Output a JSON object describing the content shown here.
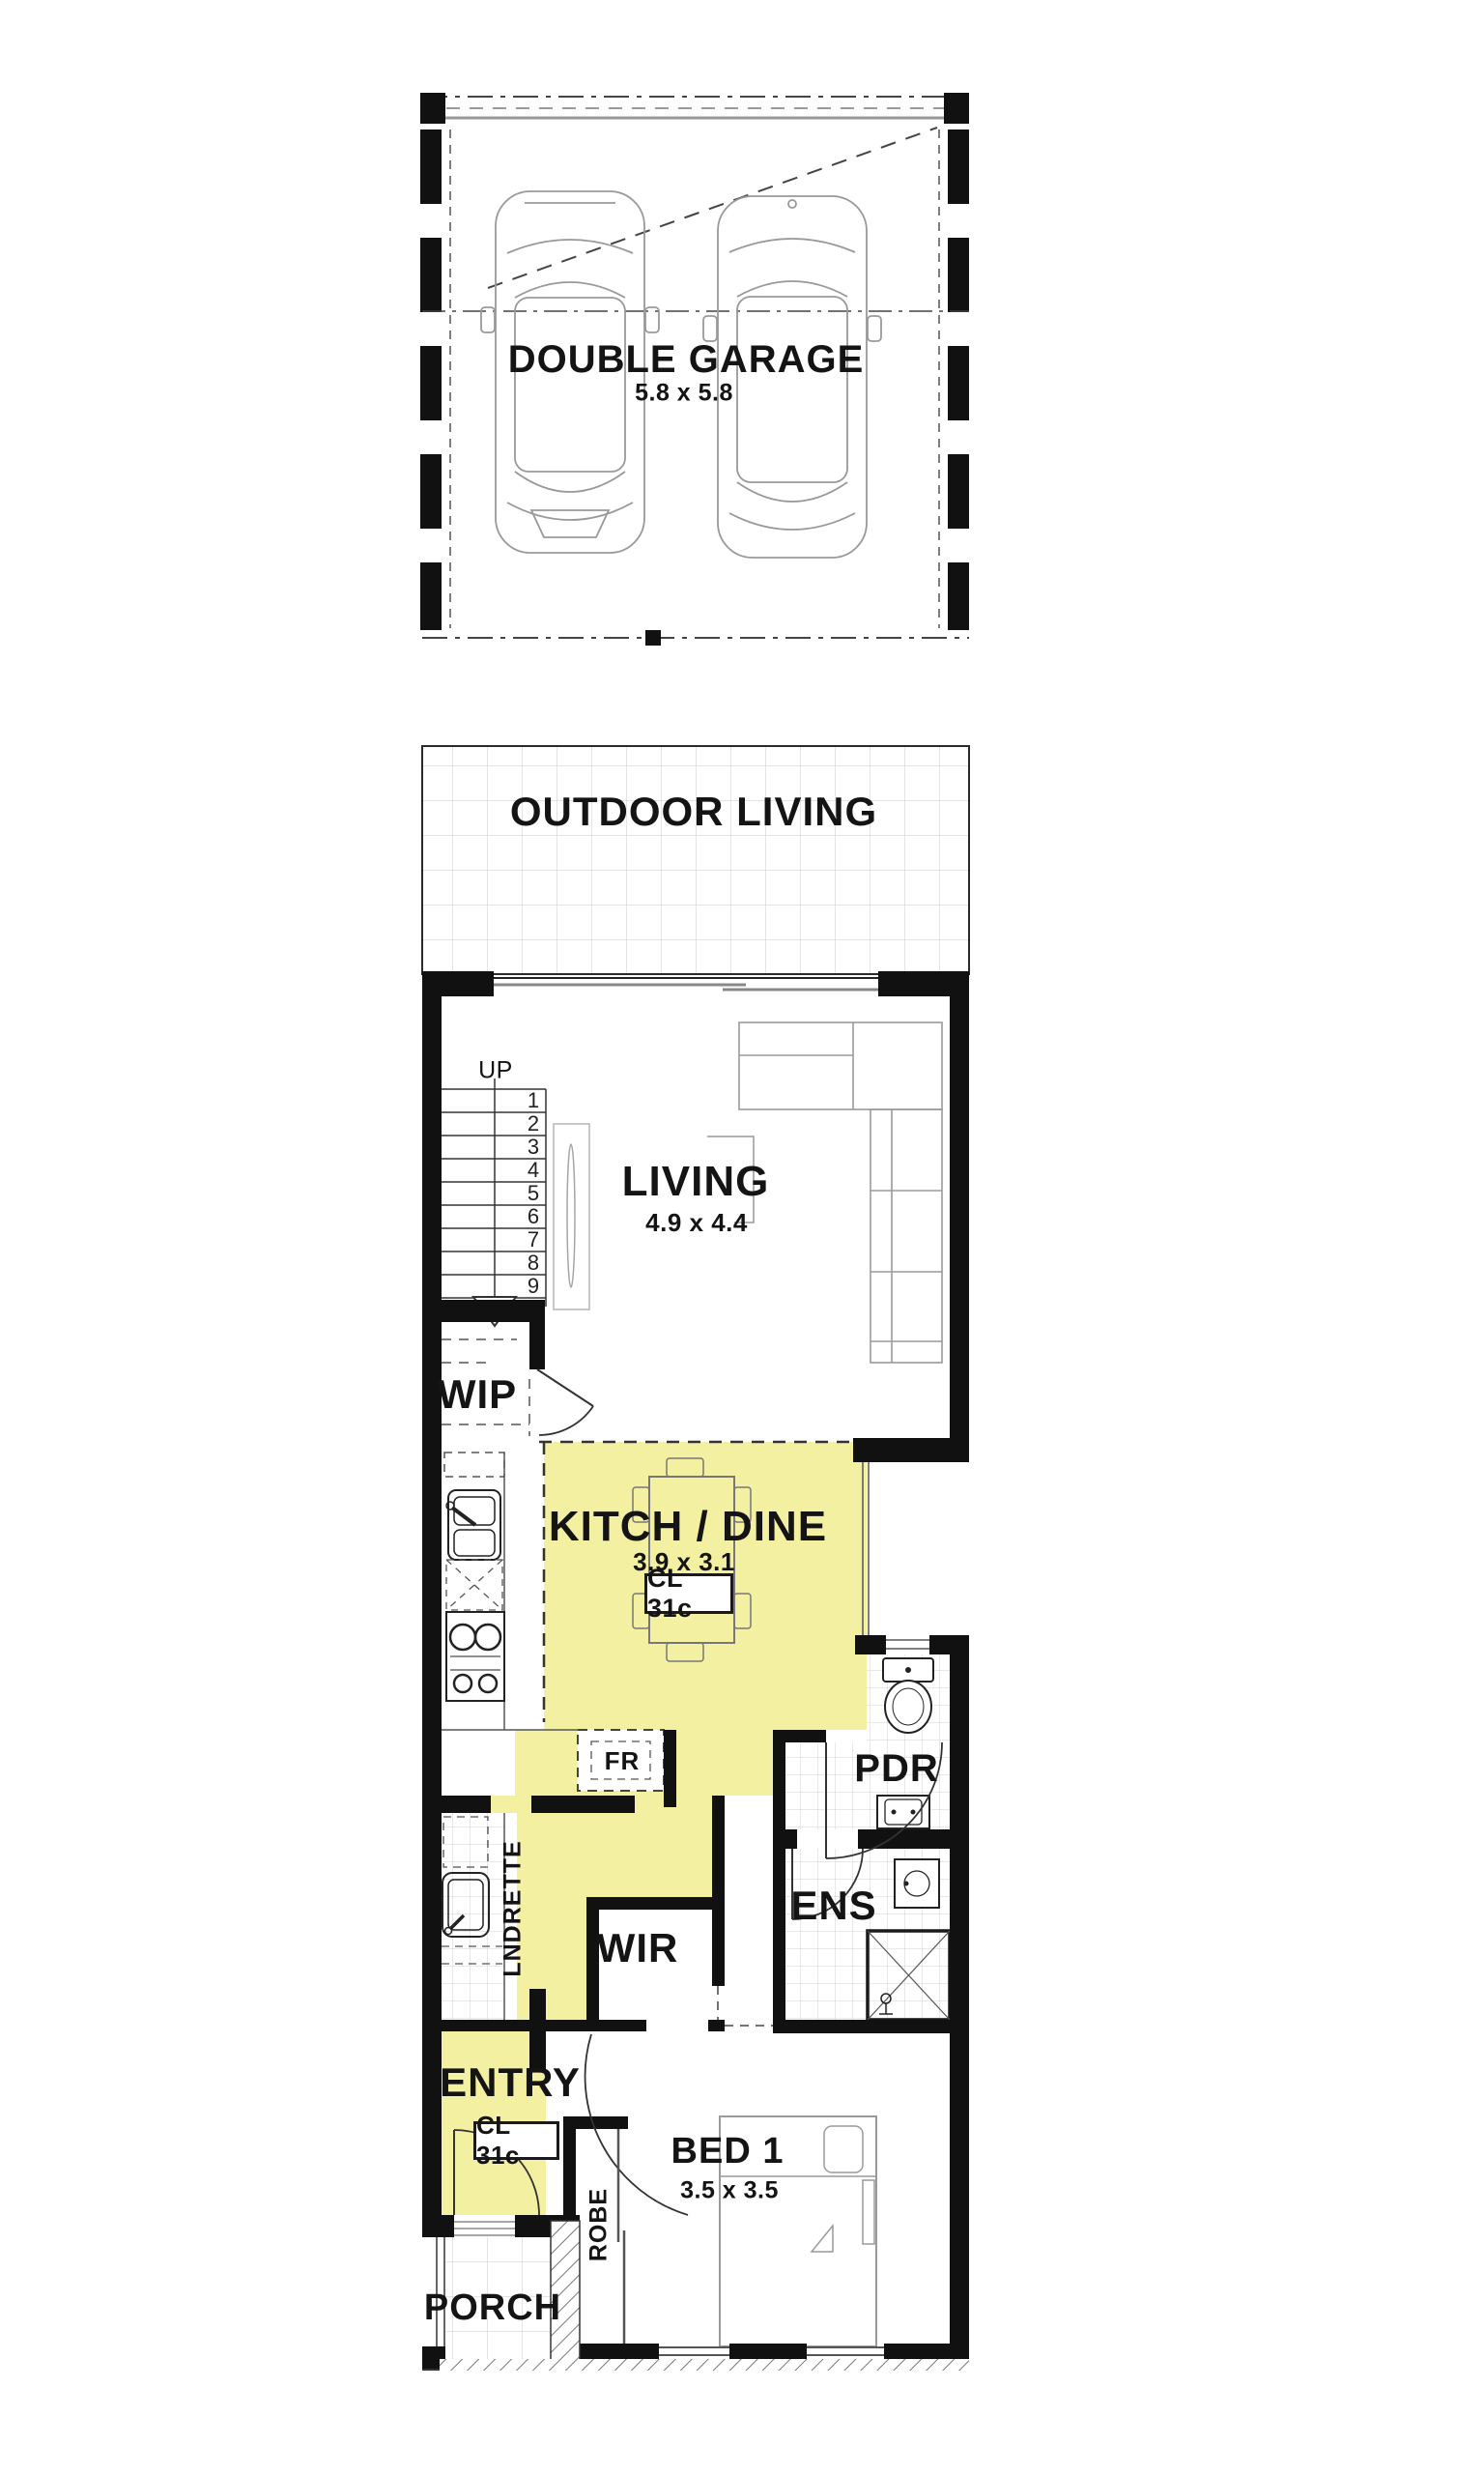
{
  "colors": {
    "highlight": "#f4f0a1",
    "wall": "#111111",
    "tile_line": "#c9c9c9"
  },
  "garage": {
    "label": "DOUBLE GARAGE",
    "dims": "5.8 x 5.8"
  },
  "outdoor_living": {
    "label": "OUTDOOR LIVING"
  },
  "living": {
    "label": "LIVING",
    "dims": "4.9 x 4.4"
  },
  "stairs": {
    "up": "UP",
    "treads": [
      "1",
      "2",
      "3",
      "4",
      "5",
      "6",
      "7",
      "8",
      "9"
    ]
  },
  "wip": {
    "label": "WIP"
  },
  "kitchen_dine": {
    "label": "KITCH / DINE",
    "dims": "3.9 x 3.1",
    "ceiling": "CL 31c",
    "fridge": "FR"
  },
  "laundry": {
    "label": "LNDRETTE"
  },
  "pdr": {
    "label": "PDR"
  },
  "ens": {
    "label": "ENS"
  },
  "wir": {
    "label": "WIR"
  },
  "entry": {
    "label": "ENTRY",
    "ceiling": "CL 31c"
  },
  "bed1": {
    "label": "BED 1",
    "dims": "3.5 x 3.5"
  },
  "robe": {
    "label": "ROBE"
  },
  "porch": {
    "label": "PORCH"
  }
}
